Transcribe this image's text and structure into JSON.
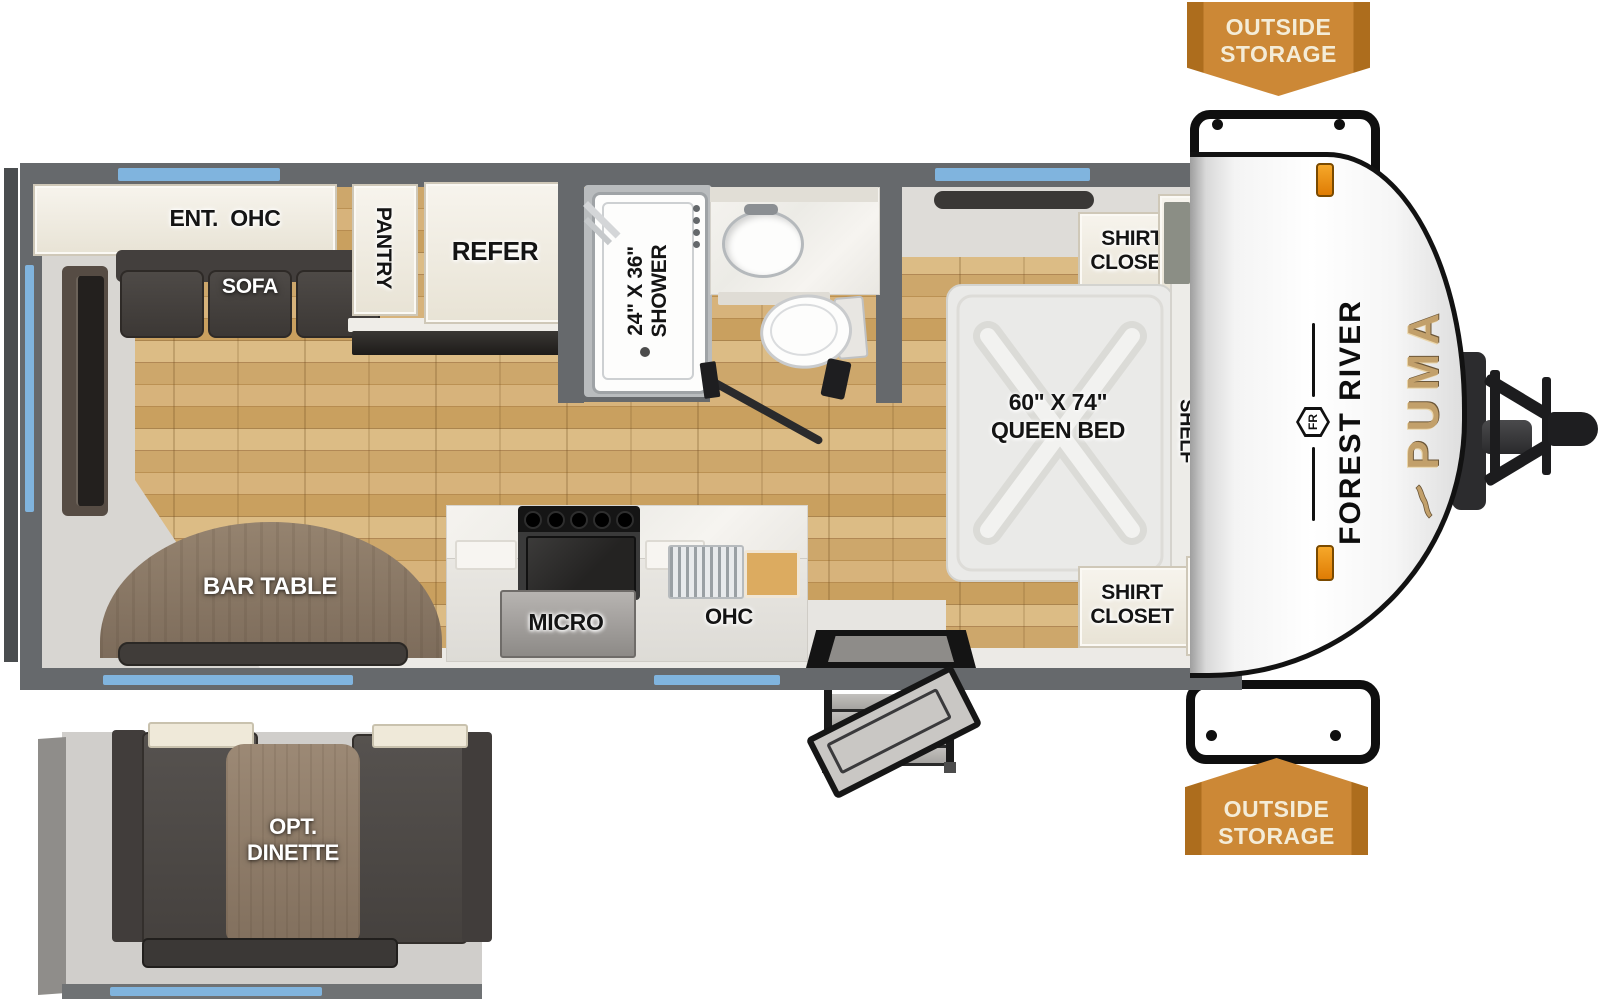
{
  "colors": {
    "banner_orange": "#cc8836",
    "banner_edge": "#ad6d1d",
    "banner_text": "#f4ecd7",
    "window_blue": "#80b4de",
    "wall_gray": "#66696c",
    "wood_floor": "#c8a263",
    "brand_gold": "#c2a06b",
    "brand_black": "#121212"
  },
  "banner_top": {
    "line1": "OUTSIDE",
    "line2": "STORAGE"
  },
  "banner_bottom": {
    "line1": "OUTSIDE",
    "line2": "STORAGE"
  },
  "branding": {
    "make": "FOREST RIVER",
    "model": "PUMA",
    "monogram": "FR"
  },
  "living": {
    "ohc": "ENT.  OHC",
    "sofa": "SOFA",
    "bar_table": "BAR TABLE"
  },
  "kitchen": {
    "pantry": "PANTRY",
    "refer": "REFER",
    "micro": "MICRO",
    "ohc": "OHC"
  },
  "bath": {
    "shower_size": "24\" X 36\"",
    "shower": "SHOWER"
  },
  "bedroom": {
    "closet_top_line1": "SHIRT",
    "closet_top_line2": "CLOSET",
    "closet_bottom_line1": "SHIRT",
    "closet_bottom_line2": "CLOSET",
    "shelf": "SHELF",
    "bed_size": "60\" X 74\"",
    "bed": "QUEEN BED"
  },
  "dinette": {
    "line1": "OPT.",
    "line2": "DINETTE"
  }
}
